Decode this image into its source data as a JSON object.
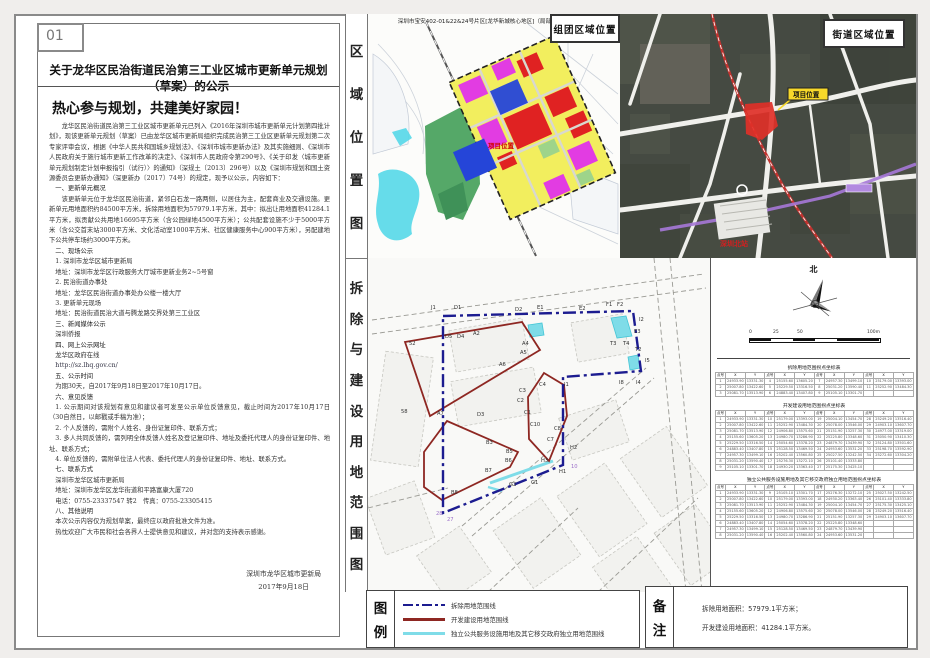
{
  "page": {
    "number": "01"
  },
  "notice": {
    "title": "关于龙华区民治街道民治第三工业区城市更新单元规划（草案）的公示",
    "headline": "热心参与规划，共建美好家园！",
    "body": [
      {
        "k": "p",
        "s": "龙华区民治街道民治第三工业区城市更新单元已列入《2016年深圳市城市更新单元计划第四批计划》，现该更新单元规划（草案）已由龙华区城市更新局组织完成民治第三工业区更新单元规划第二次专家评审会议，根据《中华人民共和国城乡规划法》、《深圳市城市更新办法》及其实施细则、《深圳市人民政府关于施行城市更新工作改革的决定》、《深圳市人民政府令第290号》、《关于印发〈城市更新单元规划制定计划申报指引（试行）〉的通知》（深规土〔2013〕296号）以及《深圳市规划和国土资源委员会更新办通知》（深更新办〔2017〕74号）的规定，现予以公示，内容如下："
      },
      {
        "k": "h",
        "s": "一、更新单元概况"
      },
      {
        "k": "p",
        "s": "该更新单元位于龙华区民治街道，紧邻白石龙一路两侧，以居住为主，配套商业及交通设施。更新单元用地面积约84500平方米，拆除用地面积为57979.1平方米，其中：拟出让用地面积41284.1平方米，拟贡献公共用地16695平方米（含公园绿地4500平方米）；公共配套设施不少于5000平方米（含公交首末站3000平方米、文化活动室1000平方米、社区健康服务中心900平方米），另配建地下公共停车场约3000平方米。"
      },
      {
        "k": "h",
        "s": "二、现场公示"
      },
      {
        "k": "l",
        "s": "1. 深圳市龙华区城市更新局"
      },
      {
        "k": "l",
        "s": "地址：深圳市龙华区行政服务大厅城市更新业务2~5号窗"
      },
      {
        "k": "l",
        "s": "2. 民治街道办事处"
      },
      {
        "k": "l",
        "s": "地址：龙华区民治街道办事处办公楼一楼大厅"
      },
      {
        "k": "l",
        "s": "3. 更新单元现场"
      },
      {
        "k": "l",
        "s": "地址：民治街道民治大道与腾龙路交界处第三工业区"
      },
      {
        "k": "h",
        "s": "三、新闻媒体公示"
      },
      {
        "k": "l",
        "s": "深圳侨报"
      },
      {
        "k": "h",
        "s": "四、网上公示网址"
      },
      {
        "k": "l",
        "s": "龙华区政府在线"
      },
      {
        "k": "u",
        "s": "http://sz.lhq.gov.cn/"
      },
      {
        "k": "h",
        "s": "五、公示时间"
      },
      {
        "k": "l",
        "s": "为期30天，自2017年9月18日至2017年10月17日。"
      },
      {
        "k": "h",
        "s": "六、意见反馈"
      },
      {
        "k": "l",
        "s": "1. 公示期间对该规划有意见和建议者可发至公示单位反馈意见，截止时间为2017年10月17日（30自然日，以邮戳或手稿为准）；"
      },
      {
        "k": "l",
        "s": "2. 个人反馈的，需附个人姓名、身份证复印件、联系方式；"
      },
      {
        "k": "l",
        "s": "3. 多人共同反馈的，需列明全体反馈人姓名及登记复印件、地址及委托代理人的身份证复印件、地址、联系方式；"
      },
      {
        "k": "l",
        "s": "4. 单位反馈的，需附单位法人代表、委托代理人的身份证复印件、地址、联系方式。"
      },
      {
        "k": "h",
        "s": "七、联系方式"
      },
      {
        "k": "l",
        "s": "深圳市龙华区城市更新局"
      },
      {
        "k": "l",
        "s": "地址：深圳市龙华区龙华街道和平路富康大厦720"
      },
      {
        "k": "l",
        "s": "电话：0755-23337547 转2　传真：0755-23305415"
      },
      {
        "k": "h",
        "s": "八、其他说明"
      },
      {
        "k": "l",
        "s": "本次公示内容仅为规划草案，最终应以政府批准文件为准。"
      },
      {
        "k": "l",
        "s": "热忱欢迎广大市民和社会各界人士提供意见和建议，并对您的支持表示感谢。"
      }
    ],
    "signature": "深圳市龙华区城市更新局",
    "date": "2017年9月18日"
  },
  "panels": {
    "region_map": {
      "side_label": "区域位置图",
      "header": "深圳市宝安402-01&22&24号片区[龙华新城核心地区]（局部）法定图则修编",
      "corner_label": "组团区域位置",
      "site_label": "项目位置"
    },
    "street_map": {
      "corner_label": "街道区域位置",
      "site_label": "项目位置",
      "station_label": "深圳北站"
    },
    "demolition_map": {
      "side_label": "拆除与建设用地范围图",
      "compass_label": "北",
      "scale_ticks": [
        "0",
        "25",
        "50",
        "100m"
      ],
      "coord_header": [
        "点号",
        "X",
        "Y"
      ],
      "tables": [
        {
          "title": "拆除用地范围拐点坐标表",
          "rows": 3,
          "points": 11
        },
        {
          "title": "开发建设用地范围拐点坐标表",
          "rows": 9,
          "points": 34
        },
        {
          "title": "独立公共服务设施用地及其它移交政府独立用地范围拐点坐标表",
          "rows": 8,
          "points": 29
        }
      ],
      "parcel_labels": [
        {
          "t": "J1",
          "x": 63,
          "y": 51
        },
        {
          "t": "D1",
          "x": 86,
          "y": 51
        },
        {
          "t": "D2",
          "x": 147,
          "y": 53
        },
        {
          "t": "E1",
          "x": 169,
          "y": 51
        },
        {
          "t": "E2",
          "x": 211,
          "y": 52
        },
        {
          "t": "F1",
          "x": 238,
          "y": 48
        },
        {
          "t": "F2",
          "x": 249,
          "y": 48
        },
        {
          "t": "I2",
          "x": 271,
          "y": 63
        },
        {
          "t": "E3",
          "x": 266,
          "y": 75
        },
        {
          "t": "T3",
          "x": 242,
          "y": 87
        },
        {
          "t": "T4",
          "x": 255,
          "y": 87
        },
        {
          "t": "T2",
          "x": 267,
          "y": 93
        },
        {
          "t": "I5",
          "x": 277,
          "y": 104
        },
        {
          "t": "I8",
          "x": 251,
          "y": 126
        },
        {
          "t": "I4",
          "x": 268,
          "y": 126
        },
        {
          "t": "I1",
          "x": 196,
          "y": 128
        },
        {
          "t": "D5",
          "x": 77,
          "y": 80
        },
        {
          "t": "D4",
          "x": 89,
          "y": 80
        },
        {
          "t": "A2",
          "x": 105,
          "y": 77
        },
        {
          "t": "A4",
          "x": 154,
          "y": 87
        },
        {
          "t": "A5",
          "x": 152,
          "y": 96
        },
        {
          "t": "A6",
          "x": 131,
          "y": 108
        },
        {
          "t": "52",
          "x": 41,
          "y": 87
        },
        {
          "t": "58",
          "x": 33,
          "y": 155
        },
        {
          "t": "A7",
          "x": 69,
          "y": 157
        },
        {
          "t": "D3",
          "x": 109,
          "y": 158
        },
        {
          "t": "B3",
          "x": 118,
          "y": 186
        },
        {
          "t": "B5",
          "x": 138,
          "y": 195
        },
        {
          "t": "B6",
          "x": 137,
          "y": 204
        },
        {
          "t": "B7",
          "x": 117,
          "y": 214
        },
        {
          "t": "B8",
          "x": 83,
          "y": 236
        },
        {
          "t": "C4",
          "x": 171,
          "y": 128
        },
        {
          "t": "C3",
          "x": 151,
          "y": 134
        },
        {
          "t": "C2",
          "x": 149,
          "y": 144
        },
        {
          "t": "C1",
          "x": 156,
          "y": 156
        },
        {
          "t": "C10",
          "x": 162,
          "y": 168
        },
        {
          "t": "C8",
          "x": 186,
          "y": 172
        },
        {
          "t": "C7",
          "x": 179,
          "y": 183
        },
        {
          "t": "H2",
          "x": 202,
          "y": 191
        },
        {
          "t": "H3",
          "x": 173,
          "y": 204
        },
        {
          "t": "H1",
          "x": 191,
          "y": 215
        },
        {
          "t": "G1",
          "x": 163,
          "y": 226
        },
        {
          "t": "G2",
          "x": 141,
          "y": 228
        },
        {
          "t": "27",
          "x": 79,
          "y": 263,
          "c": "#9b6fc9"
        },
        {
          "t": "28",
          "x": 68,
          "y": 257,
          "c": "#9b6fc9"
        },
        {
          "t": "10",
          "x": 203,
          "y": 210,
          "c": "#9b6fc9"
        }
      ]
    }
  },
  "legend": {
    "side_label": "图例",
    "items": [
      {
        "label": "拆除用地范围线",
        "color": "#1c1c90",
        "style": "dashdot"
      },
      {
        "label": "开发建设用地范围线",
        "color": "#8e2722",
        "style": "solid"
      },
      {
        "label": "独立公共服务设施用地及其它移交政府独立用地范围线",
        "color": "#7fdce8",
        "style": "solid"
      }
    ]
  },
  "remarks": {
    "side_label": "备注",
    "lines": [
      "拆除用地面积：57979.1平方米；",
      "开发建设用地面积：41284.1平方米。"
    ]
  },
  "colors": {
    "boundary_blue": "#1c1c90",
    "build_red": "#8e2722",
    "facility_cyan": "#7fdce8",
    "site_red": "#e03028",
    "tag_yellow": "#f7d82a",
    "zone_yellow": "#f2ee5e",
    "zone_red": "#e02222",
    "zone_magenta": "#e23ce2",
    "zone_blue": "#2545d8",
    "zone_green": "#55a868",
    "water_cyan": "#55d8e8"
  }
}
